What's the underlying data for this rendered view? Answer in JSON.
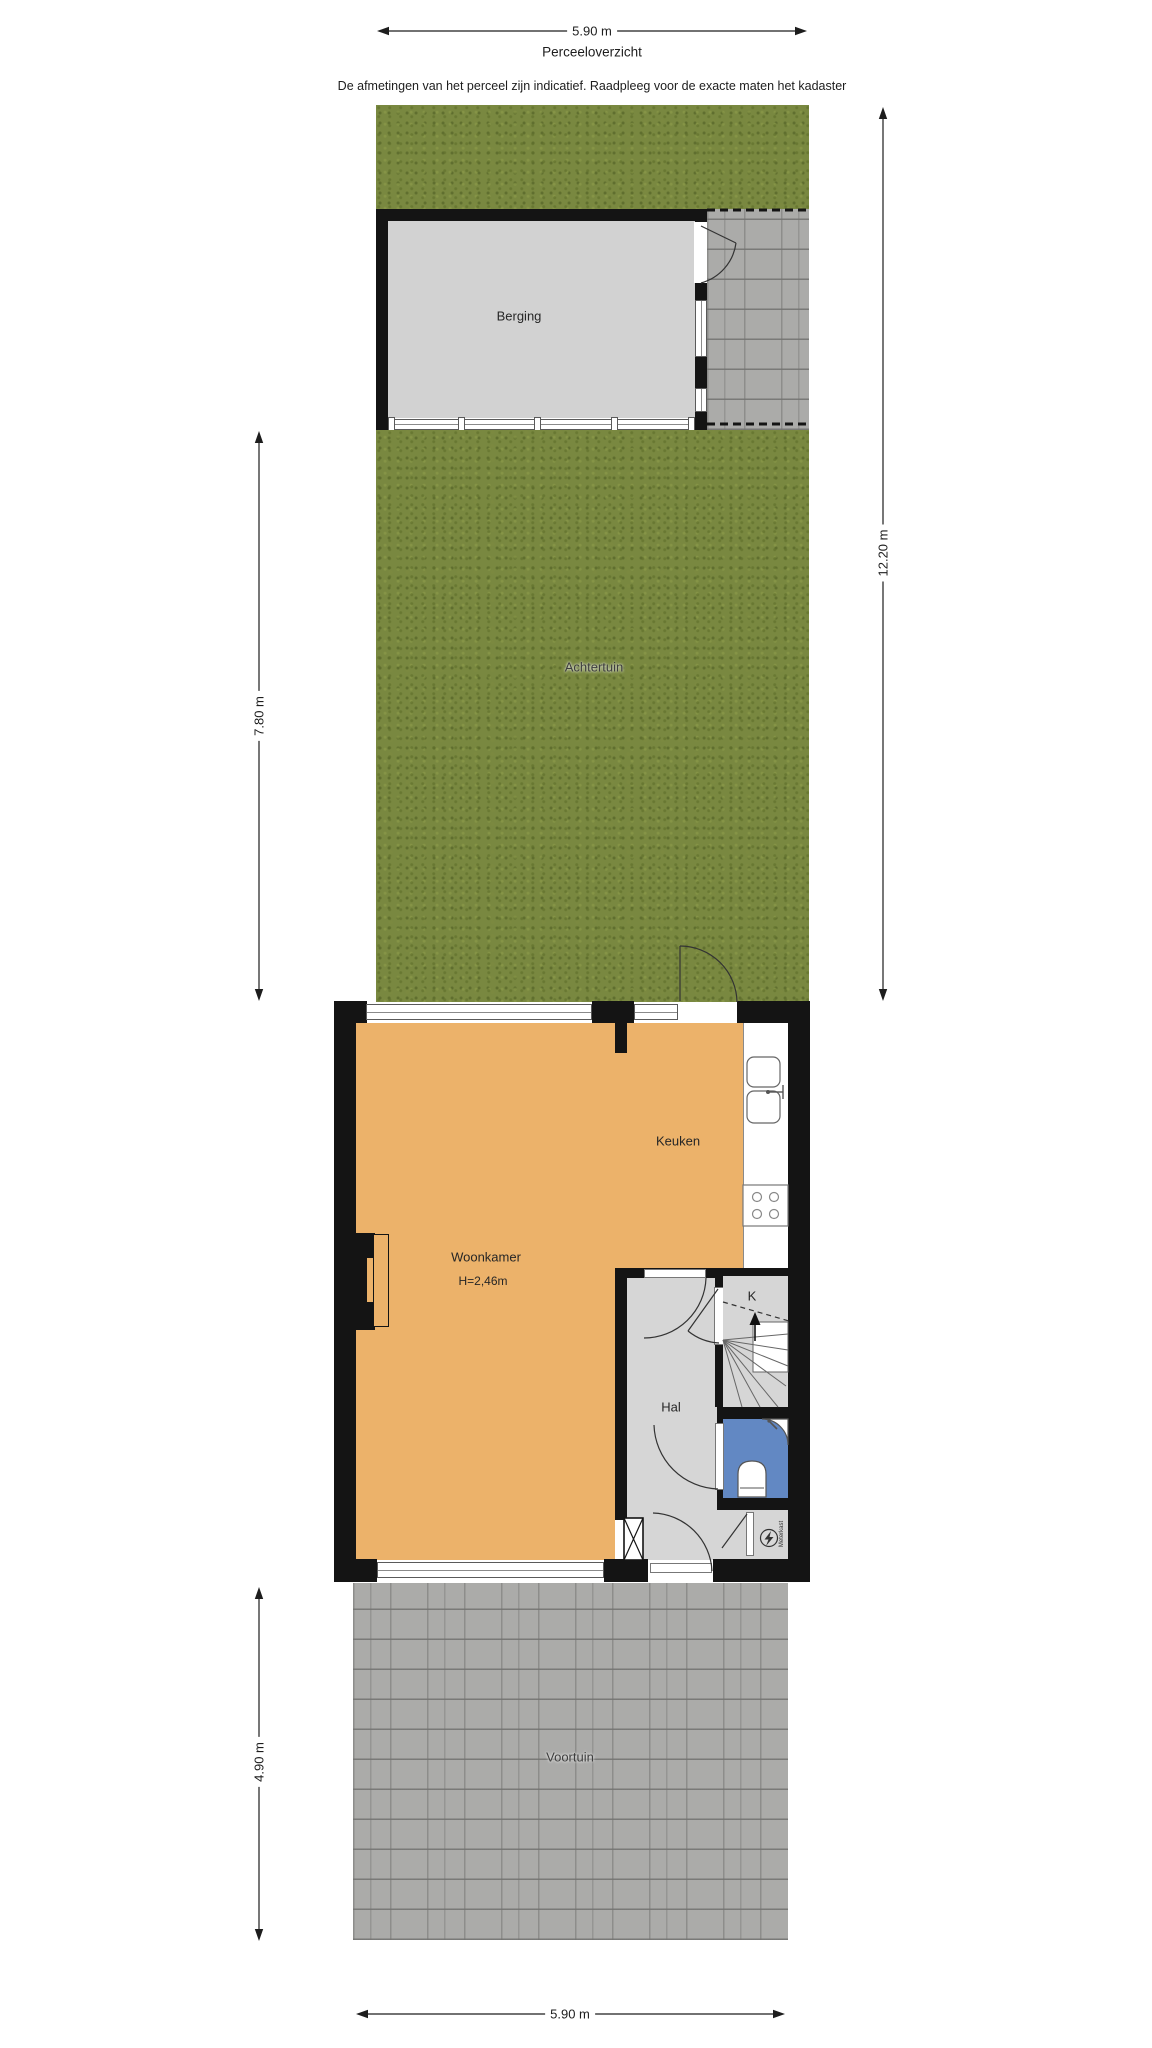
{
  "title": "Perceeloverzicht",
  "disclaimer": "De afmetingen van het perceel zijn indicatief. Raadpleeg voor de exacte maten het kadaster",
  "dimensions": {
    "top_width": "5.90 m",
    "backyard_depth": "7.80 m",
    "parcel_depth": "12.20 m",
    "frontyard_depth": "4.90 m",
    "bottom_width": "5.90 m"
  },
  "rooms": {
    "berging": "Berging",
    "achtertuin": "Achtertuin",
    "keuken": "Keuken",
    "woonkamer": "Woonkamer",
    "woonkamer_ceiling_height": "H=2,46m",
    "hal": "Hal",
    "closet": "K",
    "voortuin": "Voortuin",
    "meterkast": "Meterkast"
  },
  "colors": {
    "wall": "#141414",
    "floor_living": "#ecb26a",
    "floor_hall": "#d6d6d6",
    "floor_shed": "#d2d2d2",
    "bathroom_floor": "#6288c3",
    "grass": "#798840",
    "paving": "#ababa9"
  }
}
